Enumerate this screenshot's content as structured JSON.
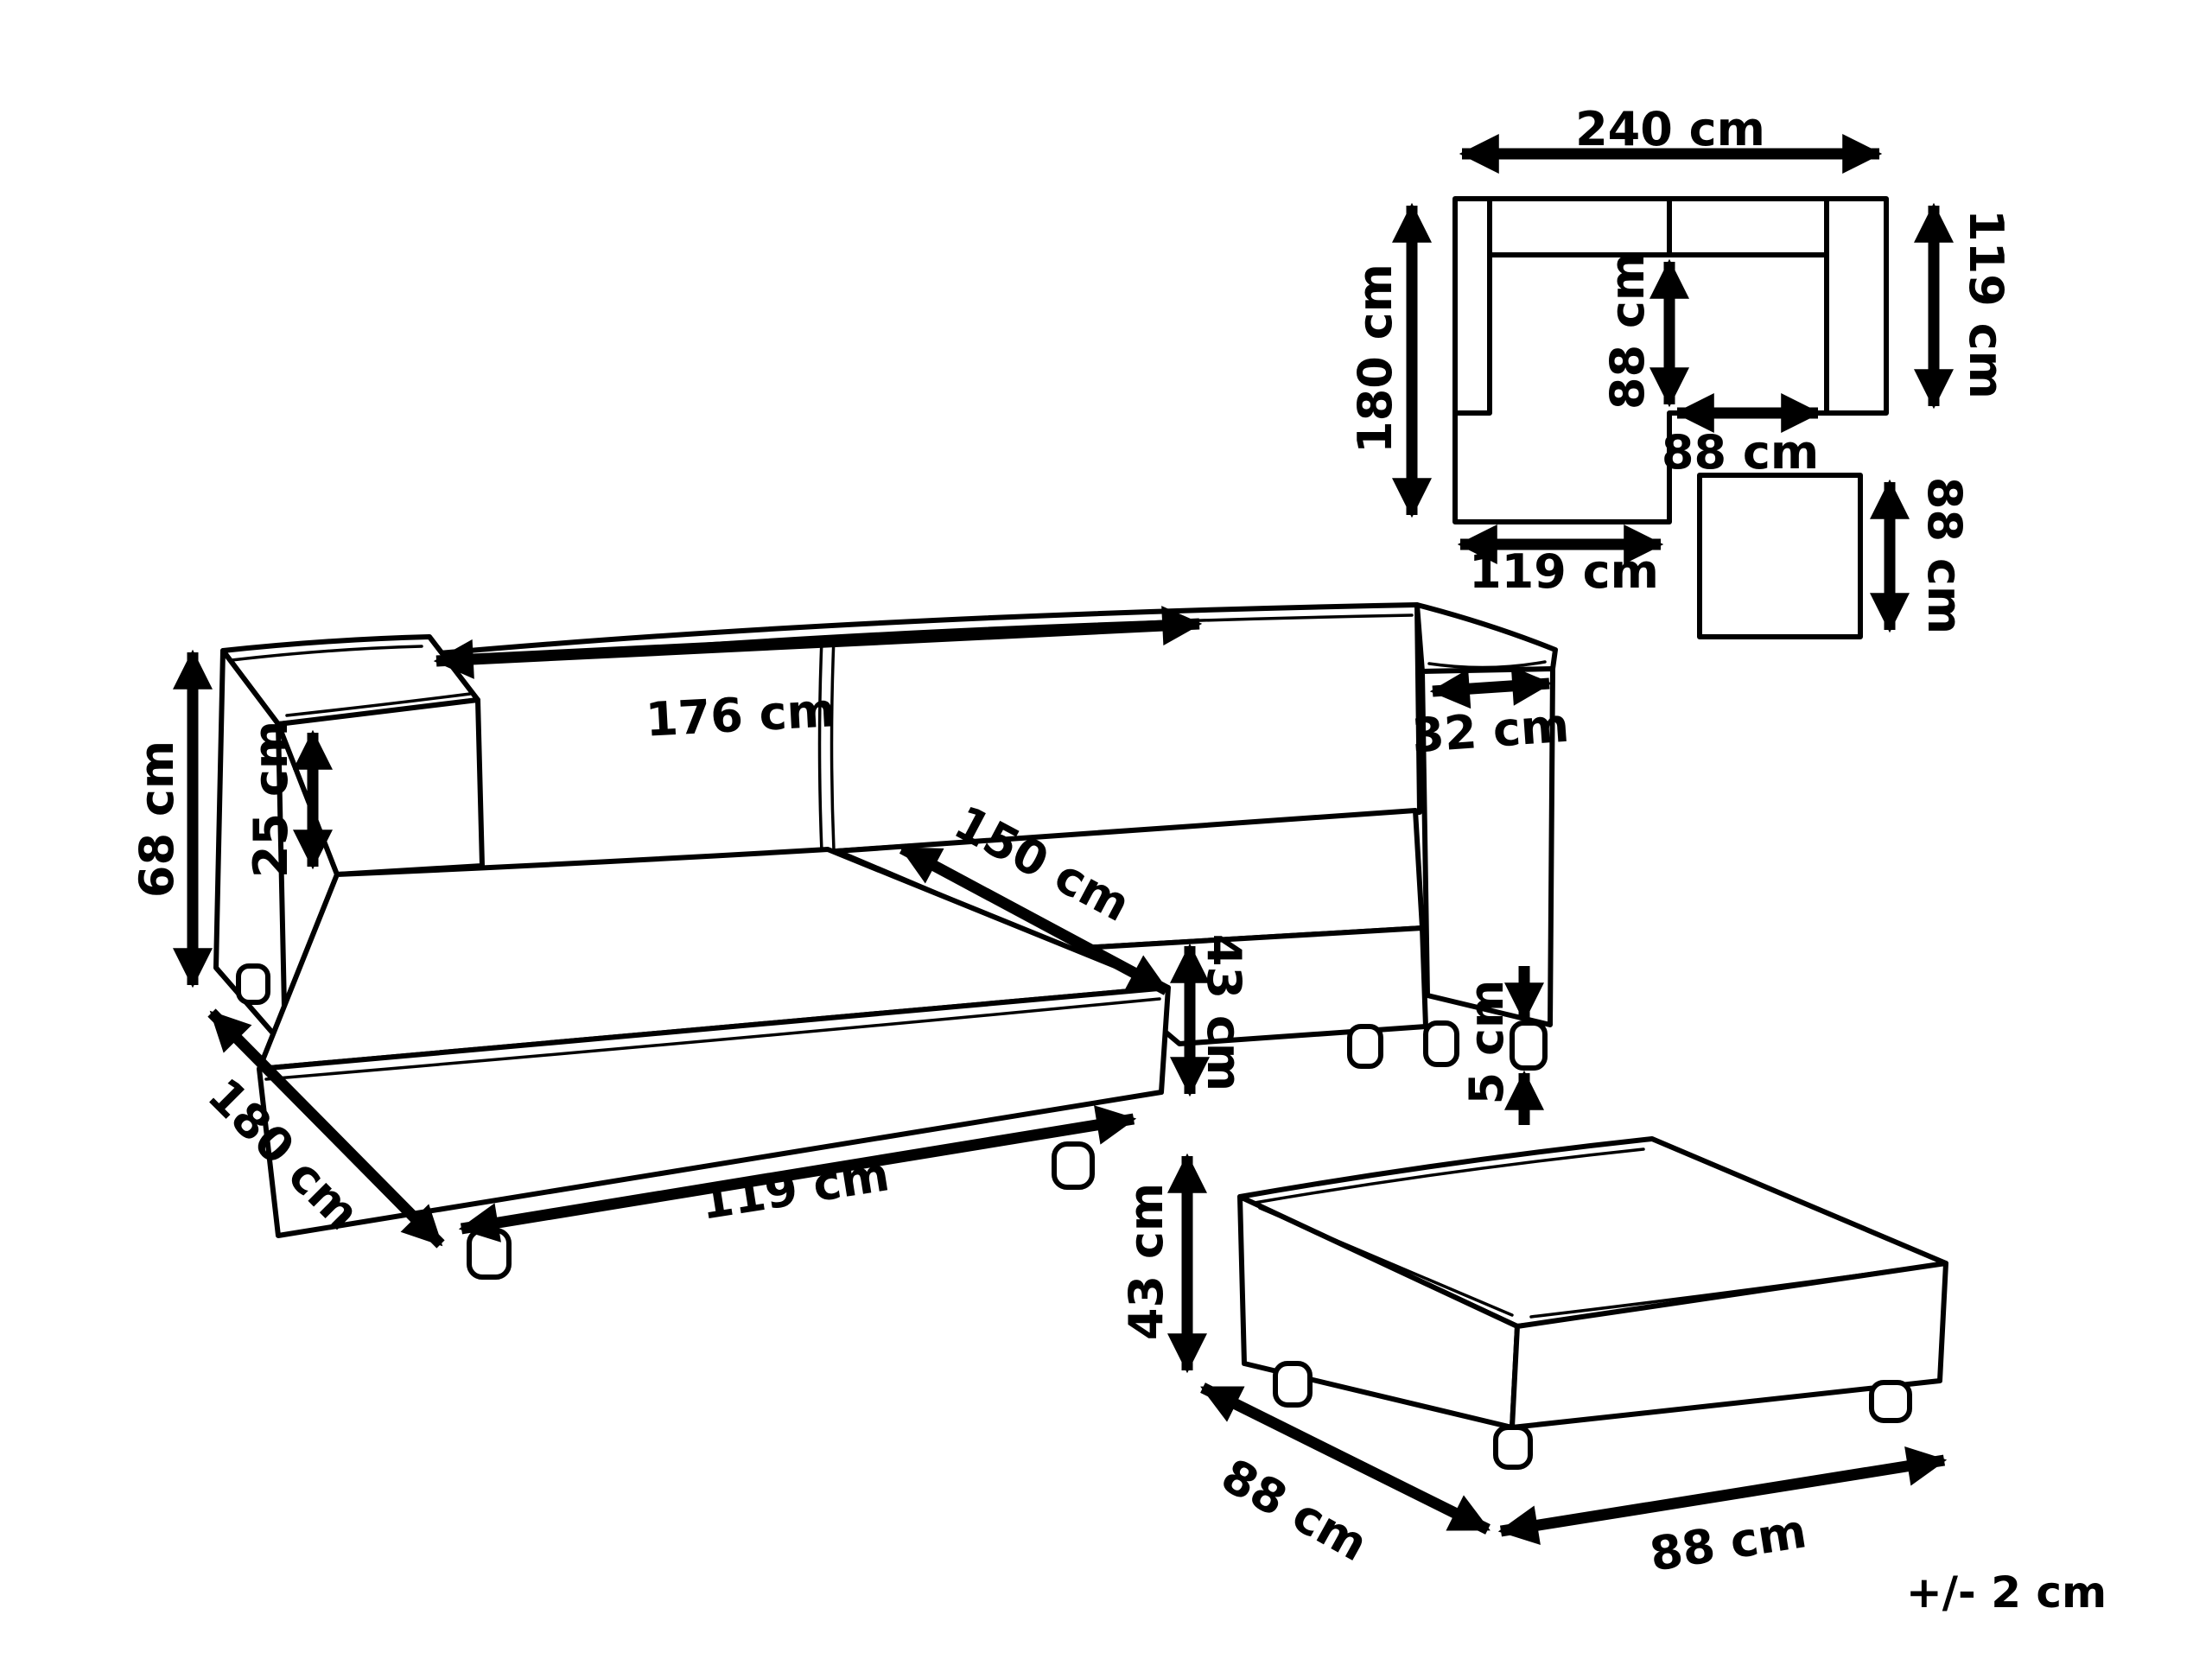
{
  "page": {
    "background_color": "#ffffff",
    "line_color": "#000000",
    "tolerance_note": "+/- 2 cm"
  },
  "plan_view": {
    "overall_width": "240 cm",
    "left_side_depth": "180 cm",
    "right_side_depth": "119 cm",
    "inner_seat_depth": "88 cm",
    "inner_seat_width": "88 cm",
    "chaise_width": "119 cm",
    "ottoman_plan_size": "88 cm"
  },
  "sofa_view": {
    "total_height": "68 cm",
    "backrest_width": "176 cm",
    "backrest_height_above_seat": "25 cm",
    "seat_depth": "150 cm",
    "armrest_width": "32 cm",
    "seat_height": "43 cm",
    "leg_height": "5 cm",
    "chaise_total_depth": "180 cm",
    "chaise_front_width": "119 cm"
  },
  "ottoman_view": {
    "height": "43 cm",
    "depth": "88 cm",
    "width": "88 cm"
  }
}
